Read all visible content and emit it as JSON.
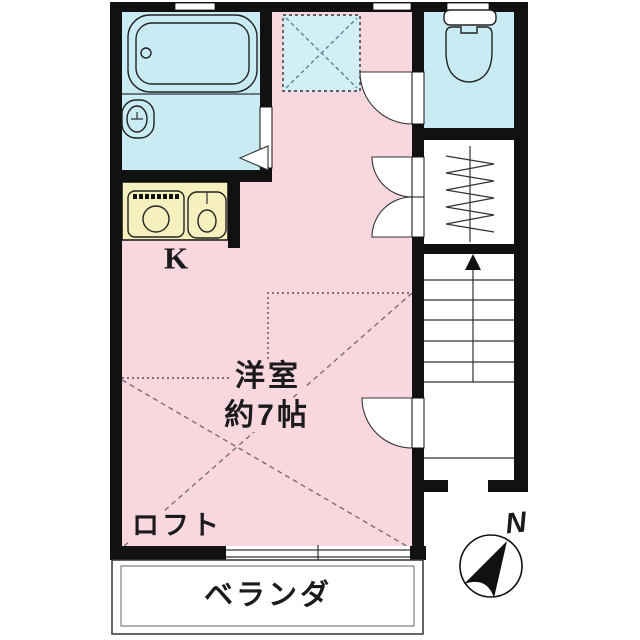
{
  "plan": {
    "type": "japanese-apartment-floor-plan",
    "labels": {
      "room_name": "洋室",
      "room_size": "約7帖",
      "loft": "ロフト",
      "balcony": "ベランダ",
      "kitchen": "K",
      "compass_north": "N"
    },
    "rooms": [
      {
        "name": "western-room",
        "label": "洋室 約7帖",
        "fill": "pink"
      },
      {
        "name": "kitchen",
        "label": "K",
        "fill": "yellow"
      },
      {
        "name": "bathroom-washroom",
        "label": "",
        "fill": "blue"
      },
      {
        "name": "toilet",
        "label": "",
        "fill": "blue"
      },
      {
        "name": "closet",
        "label": "",
        "fill": "white"
      },
      {
        "name": "staircase",
        "label": "",
        "fill": "white"
      },
      {
        "name": "loft-overhead",
        "label": "ロフト",
        "fill": "pink"
      },
      {
        "name": "balcony",
        "label": "ベランダ",
        "fill": "white"
      }
    ],
    "icons": [
      "bathtub-icon",
      "washbasin-icon",
      "stove-icon",
      "kitchen-sink-icon",
      "toilet-icon",
      "hanger-icon",
      "stairs-up-arrow-icon",
      "compass-icon",
      "door-swing-arc",
      "door-triangle-icon",
      "skylight-x-icon"
    ],
    "colors": {
      "room_pink": "#f8d7de",
      "water_blue": "#c9ebf4",
      "skylight_blue": "#d2eef6",
      "kitchen_yellow": "#f5f0bd",
      "wall_black": "#111111",
      "white": "#ffffff"
    }
  }
}
